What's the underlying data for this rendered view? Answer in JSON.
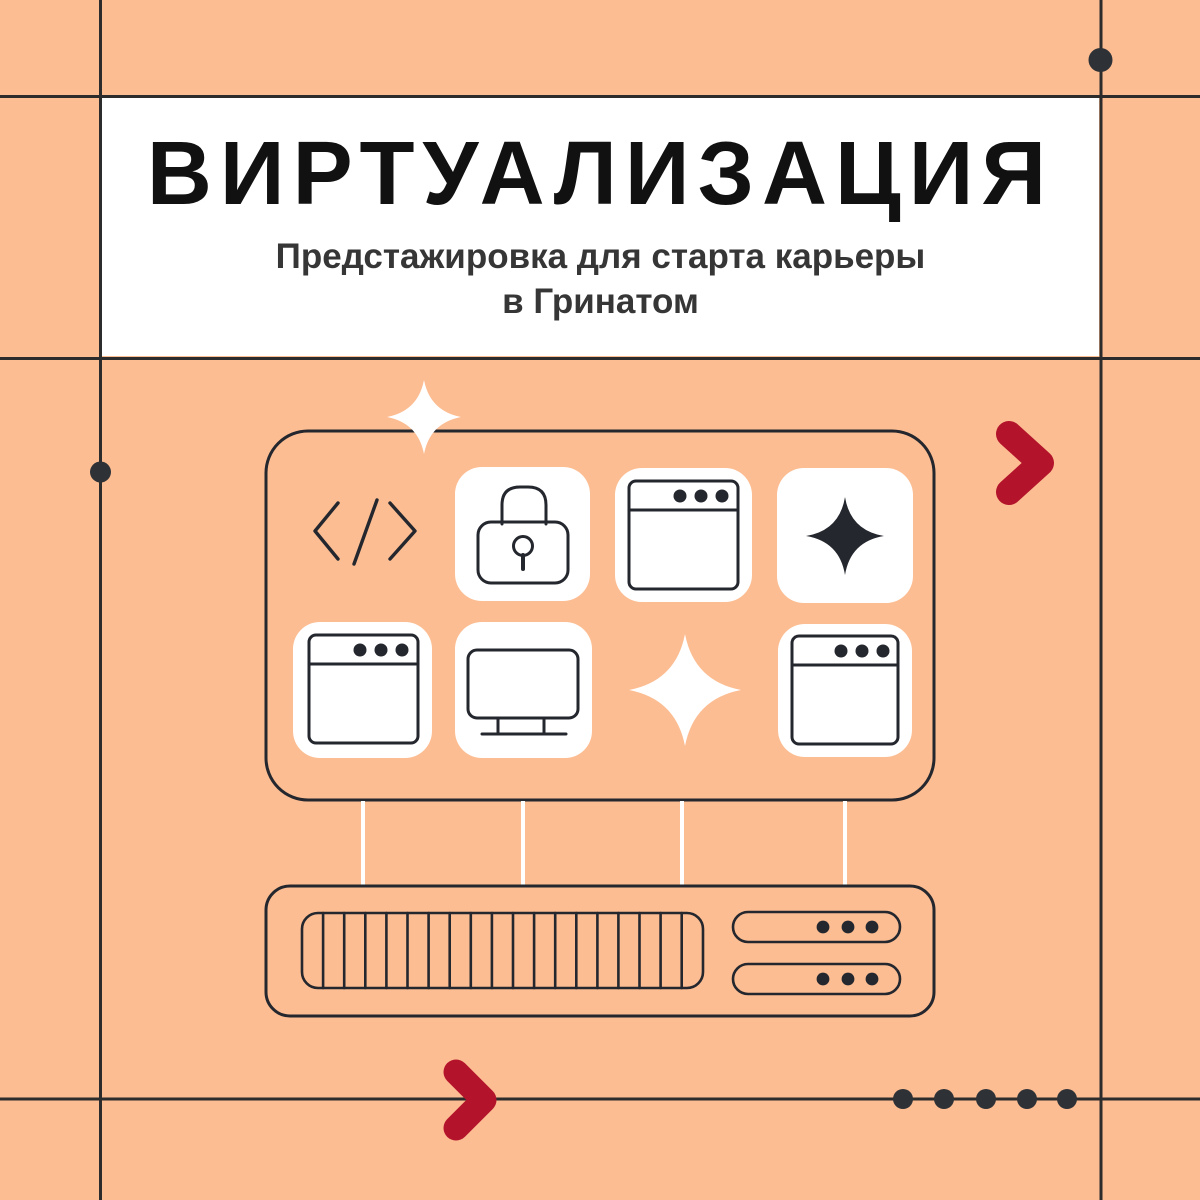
{
  "poster": {
    "title": "ВИРТУАЛИЗАЦИЯ",
    "subtitle_line1": "Предстажировка для старта карьеры",
    "subtitle_line2": "в Гринатом"
  },
  "colors": {
    "background": "#fcbd92",
    "banner_background": "#ffffff",
    "line": "#2c2c2c",
    "icon_stroke": "#24272e",
    "accent_red": "#b3142b",
    "dot": "#2e3237",
    "title_text": "#111111",
    "subtitle_text": "#363636"
  },
  "illustration": {
    "app_icons": [
      "code",
      "lock",
      "browser",
      "sparkle",
      "browser",
      "monitor",
      "sparkle",
      "browser"
    ],
    "connector_count": 4,
    "server_rack": {
      "vent_slat_count": 18,
      "unit_count": 2,
      "dots_per_unit": 3
    }
  },
  "decorations": {
    "chevron_count": 2,
    "grid_dot_count": 2,
    "bottom_dot_row_count": 5,
    "sparkle_count": 3
  }
}
